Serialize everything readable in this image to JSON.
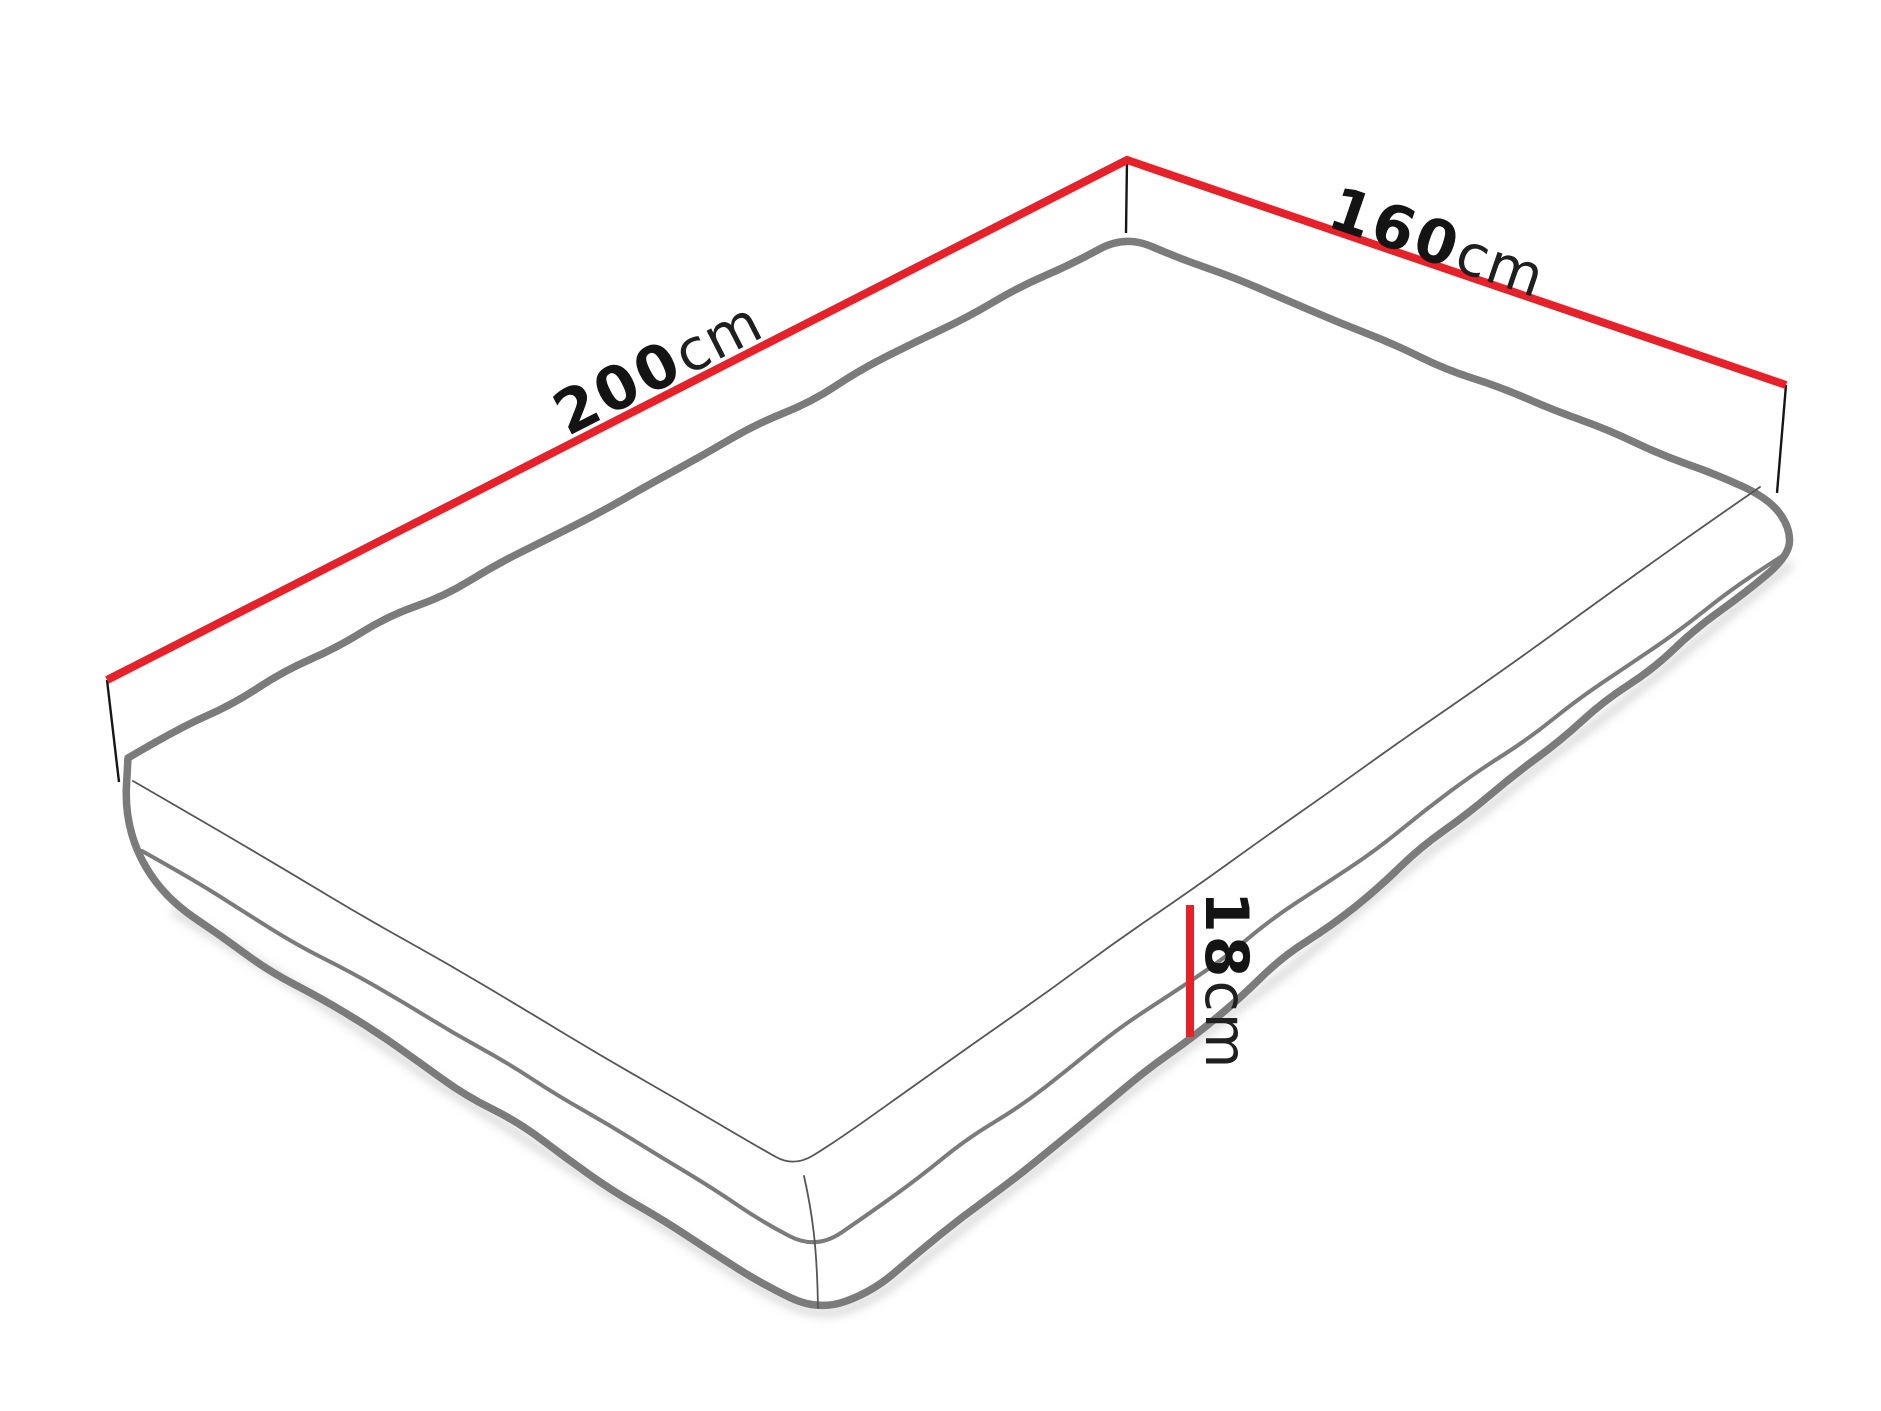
{
  "diagram": {
    "subject": "mattress-dimensions",
    "dimensions": {
      "length": {
        "value": "200",
        "unit": "cm"
      },
      "width": {
        "value": "160",
        "unit": "cm"
      },
      "height": {
        "value": "18",
        "unit": "cm"
      }
    },
    "colors": {
      "dimension_line": "#e62129",
      "outline": "#7b7b7b",
      "seam": "#565656",
      "connector": "#161616",
      "text": "#141414"
    }
  }
}
